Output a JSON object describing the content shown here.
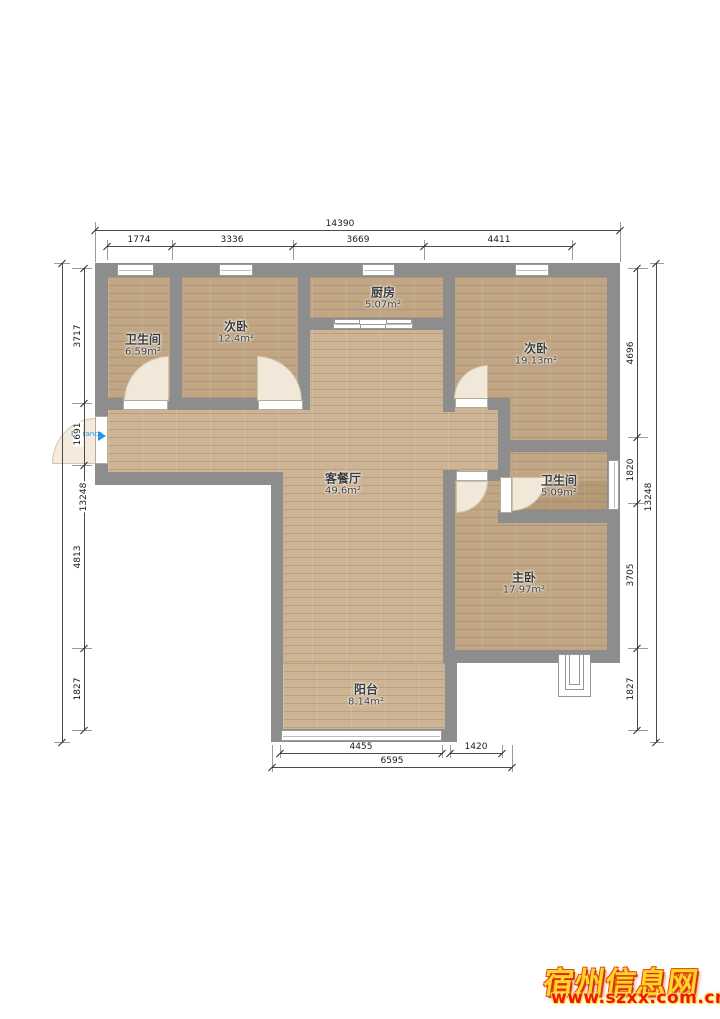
{
  "plan": {
    "entrance_label": "Entrance",
    "rooms": [
      {
        "name": "卫生间",
        "area": "6.59m²"
      },
      {
        "name": "次卧",
        "area": "12.4m²"
      },
      {
        "name": "厨房",
        "area": "5.07m²"
      },
      {
        "name": "次卧",
        "area": "19.13m²"
      },
      {
        "name": "客餐厅",
        "area": "49.6m²"
      },
      {
        "name": "卫生间",
        "area": "5.09m²"
      },
      {
        "name": "主卧",
        "area": "17.97m²"
      },
      {
        "name": "阳台",
        "area": "8.14m²"
      }
    ],
    "dimensions": {
      "top": {
        "total": "14390",
        "segments": [
          "1774",
          "3336",
          "3669",
          "4411"
        ]
      },
      "left": {
        "total": "13248",
        "segments": [
          "3717",
          "1691",
          "4813",
          "1827"
        ]
      },
      "right": {
        "total": "13248",
        "segments": [
          "4696",
          "1820",
          "3705",
          "1827"
        ]
      },
      "bottom": {
        "total": "6595",
        "segments": [
          "4455",
          "1420"
        ]
      }
    }
  },
  "watermark": {
    "site_name": "宿州信息网",
    "site_url": "www.szxx.com.cn"
  },
  "colors": {
    "wall": "#8d8d8d",
    "floor": "#cdb494",
    "entrance_blue": "#2596e8",
    "watermark_yellow": "#ffd22e",
    "watermark_red": "#ee1800"
  }
}
